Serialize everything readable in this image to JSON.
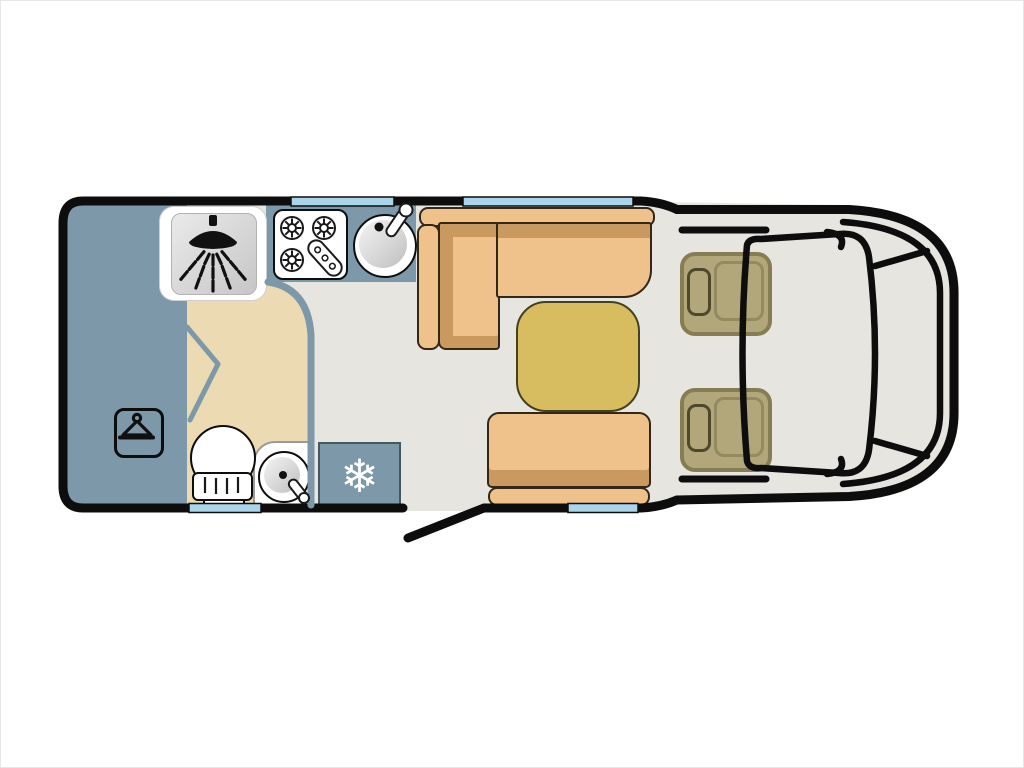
{
  "title": "Motorhome floor plan diagram",
  "icons": {
    "snowflake": "❄",
    "list": [
      "shower-icon",
      "hanger-icon",
      "snowflake-icon",
      "gas-burner-icon",
      "sink-icon",
      "toilet-icon"
    ]
  },
  "rooms": [
    "rear-bedroom",
    "washroom",
    "shower-cubicle",
    "kitchen",
    "dinette-lounge",
    "cab"
  ],
  "fixtures": [
    "wardrobe",
    "shower",
    "toilet",
    "washbasin",
    "fridge",
    "hob-3-burner",
    "kitchen-sink",
    "l-shaped-sofa",
    "table",
    "travel-bench",
    "driver-seat",
    "passenger-seat"
  ],
  "colors": {
    "outline": "#0d0d0d",
    "floor": "#e6e5df",
    "blue": "#7d98a8",
    "beige": "#ecdab2",
    "sofa": "#efc28b",
    "sofaShade": "#c9995f",
    "sofaLine": "#332817",
    "tableFill": "#d8bd60",
    "tableLine": "#45401d",
    "seatFill": "#b2a77b",
    "seatLine": "#877d55",
    "seatInner": "#938a60",
    "headrestLine": "#4e482c",
    "windowFill": "#a9d4ea",
    "white": "#ffffff",
    "grayLine": "#9a9a9a"
  }
}
